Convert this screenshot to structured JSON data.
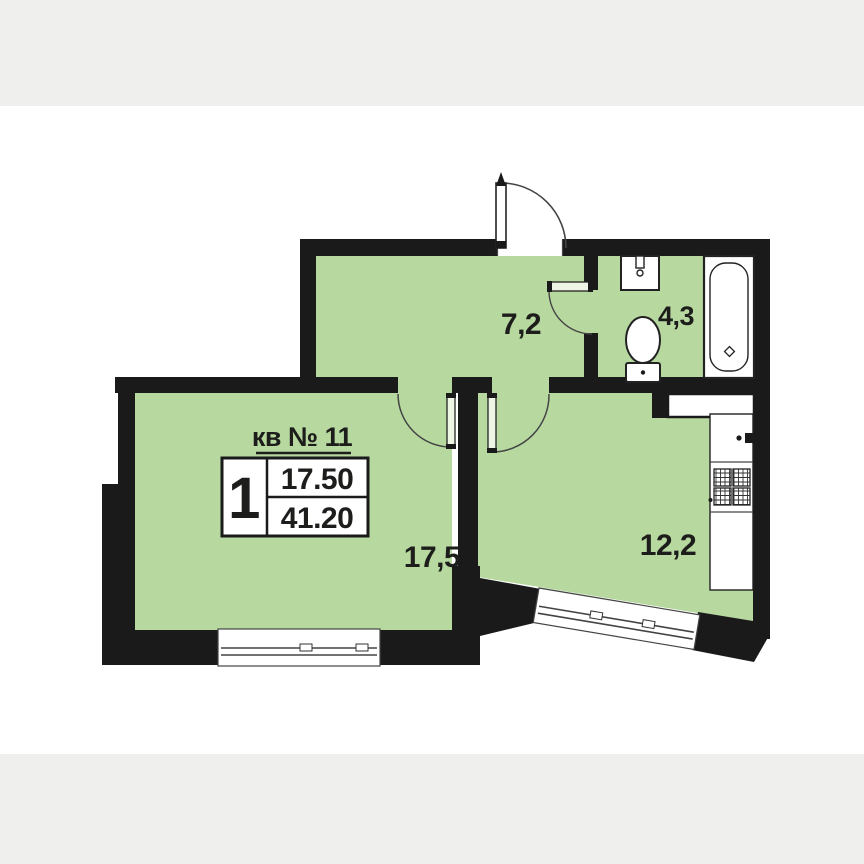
{
  "plan": {
    "apartment_label": "кв № 11",
    "info_table": {
      "rooms_count": "1",
      "living_area": "17.50",
      "total_area": "41.20"
    },
    "rooms": [
      {
        "id": "hall",
        "area_label": "7,2"
      },
      {
        "id": "bathroom",
        "area_label": "4,3"
      },
      {
        "id": "living-room",
        "area_label": "17,5"
      },
      {
        "id": "kitchen",
        "area_label": "12,2"
      }
    ],
    "fixtures": [
      "bathtub",
      "wash-basin",
      "toilet",
      "kitchen-sink",
      "stove",
      "vent-shaft"
    ],
    "colors": {
      "floor_green": "#b7d9a0",
      "wall_black": "#1a1a1a",
      "background_band": "#efefed",
      "paper": "#ffffff",
      "text": "#1d1d1b"
    }
  }
}
